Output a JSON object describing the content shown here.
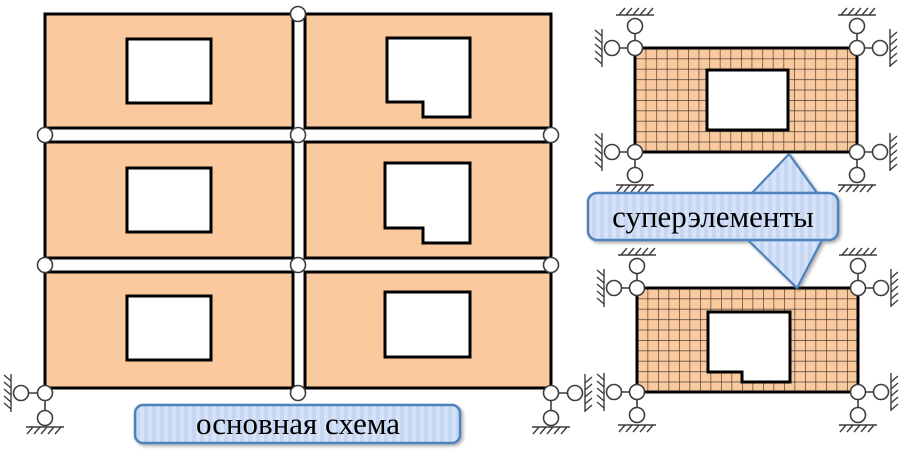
{
  "labels": {
    "main_scheme": "основная схема",
    "superelements": "суперэлементы"
  },
  "main_scheme": {
    "panel_rows": 3,
    "panel_columns": 2,
    "window_types": [
      "rectangular",
      "l-shaped-notch"
    ],
    "hinge_nodes": 8,
    "supports": [
      "bottom-left",
      "bottom-right"
    ]
  },
  "superelements": {
    "count": 2,
    "mesh": "rectangular finite-element grid",
    "corner_supports_each": 4
  },
  "colors": {
    "panel_fill": "#FACA9E",
    "outline": "#000000",
    "mesh_line": "#4A4038",
    "callout_fill": "#D5E2F8",
    "callout_stripe": "#C6D7F3",
    "accent": "#4F81BD",
    "node_stroke": "#3D3D3D"
  }
}
